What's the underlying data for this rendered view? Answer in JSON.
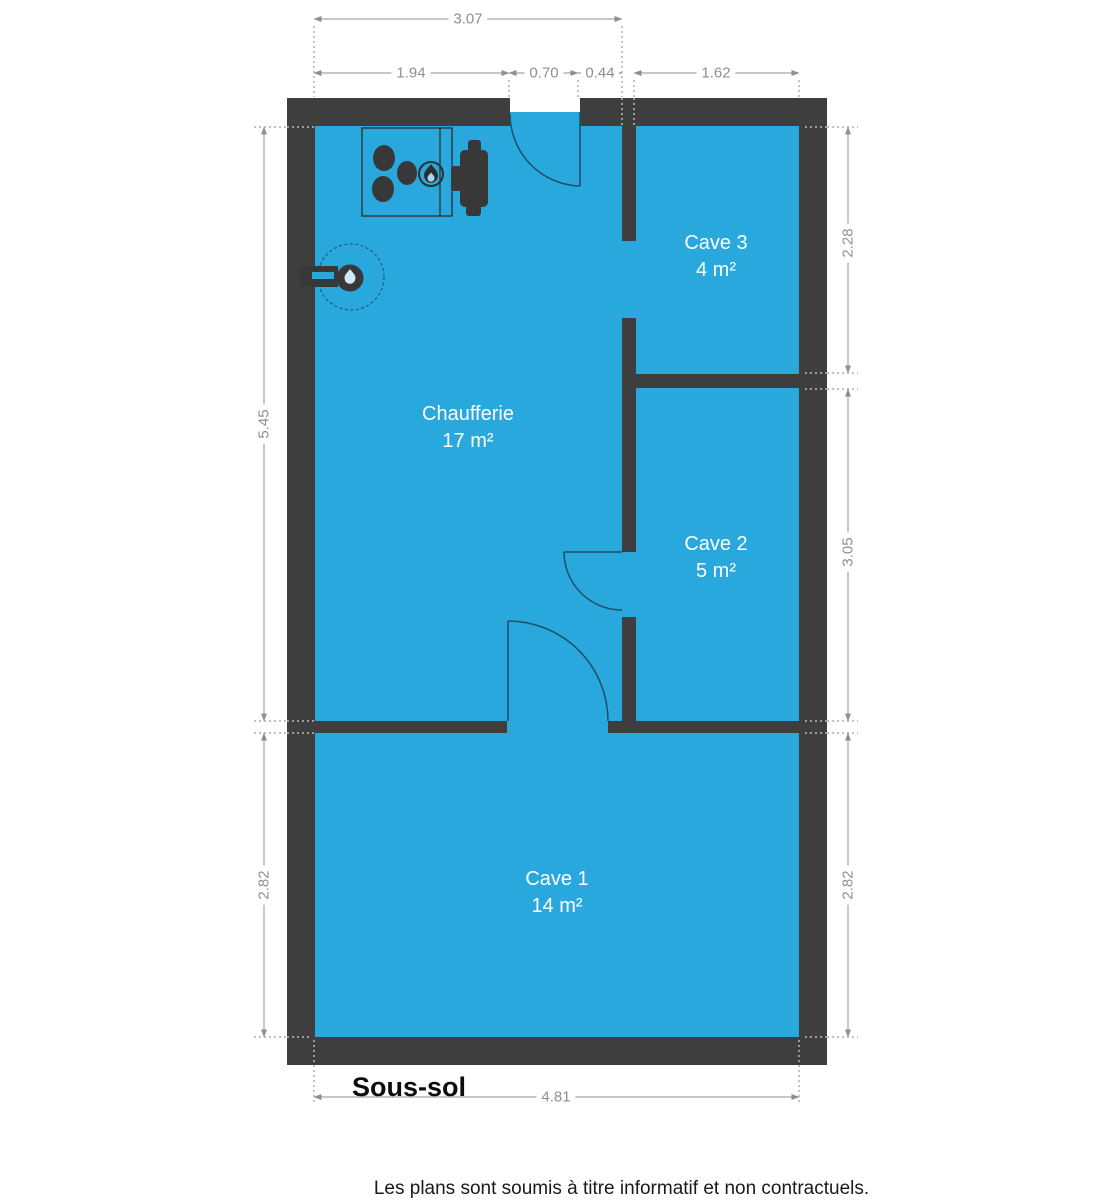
{
  "plan": {
    "floor_label": "Sous-sol",
    "footer": "Les plans sont soumis à titre informatif et non contractuels.",
    "rooms": [
      {
        "name": "Chaufferie",
        "area": "17 m²"
      },
      {
        "name": "Cave 3",
        "area": "4 m²"
      },
      {
        "name": "Cave 2",
        "area": "5 m²"
      },
      {
        "name": "Cave 1",
        "area": "14 m²"
      }
    ],
    "dimensions": {
      "top": [
        "3.07",
        "1.94",
        "0.70",
        "0.44",
        "1.62"
      ],
      "left": [
        "5.45",
        "2.82"
      ],
      "right": [
        "2.28",
        "3.05",
        "2.82"
      ],
      "bottom": [
        "4.81"
      ]
    },
    "icons": [
      "boiler-burners-icon",
      "flame-icon",
      "water-heater-icon",
      "water-meter-icon",
      "door-swing-arc"
    ],
    "colors": {
      "room_fill": "#29A8DD",
      "wall": "#3E3E3E",
      "dimension_gray": "#8F8F8F",
      "door_line": "#1E4E67",
      "room_label_text": "#FFFFFF"
    }
  }
}
